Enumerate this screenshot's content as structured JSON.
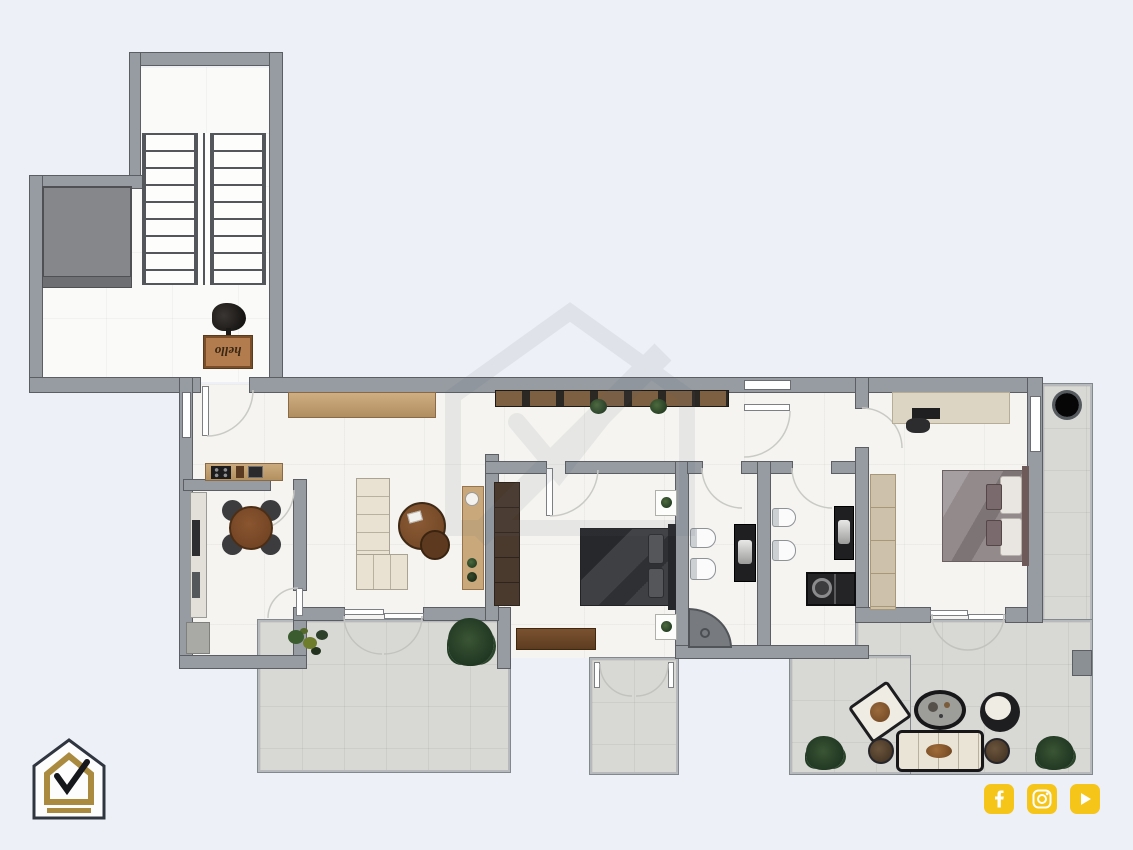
{
  "canvas": {
    "width": 1133,
    "height": 850
  },
  "colors": {
    "background": "#edf0f6",
    "wall_fill": "#969ca2",
    "wall_edge": "#5b5f64",
    "floor": "#f5f4f1",
    "marble_floor": "#fafaf8",
    "terrace_tile": "#d8d8d5",
    "wood": "#c2a175",
    "dark_wood": "#4a3a2e",
    "sofa_cream": "#e9e2d2",
    "charcoal": "#2c2c2e",
    "logo_gold": "#a98a3f",
    "logo_outline": "#30363f",
    "social_yellow": "#f6c51a",
    "plant_green": "#3c5531",
    "door_arc": "#c9c9c5"
  },
  "entry": {
    "doormat_text": "hello"
  },
  "social": {
    "icons": [
      {
        "name": "facebook-icon"
      },
      {
        "name": "instagram-icon"
      },
      {
        "name": "youtube-icon"
      }
    ]
  },
  "branding": {
    "logo_name": "house-check-logo",
    "watermark_name": "house-check-watermark"
  }
}
